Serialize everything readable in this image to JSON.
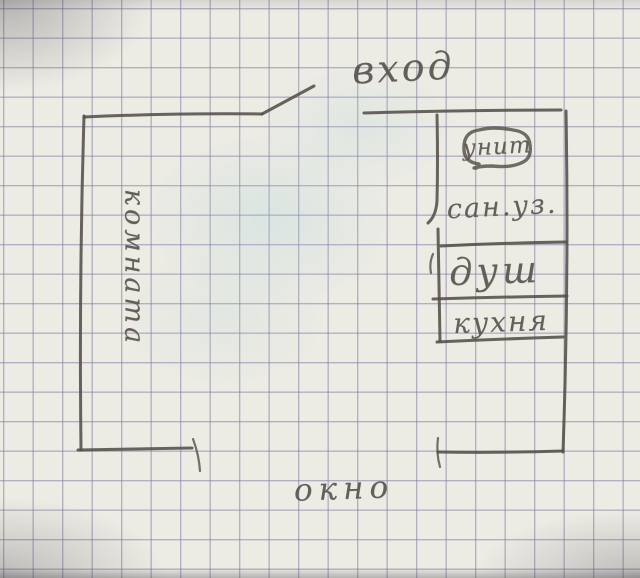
{
  "labels": {
    "entrance": "вход",
    "room": "комната",
    "toilet": "унит",
    "san_unit": "сан.уз.",
    "shower": "душ",
    "kitchen": "кухня",
    "window": "окно"
  },
  "colors": {
    "paper": "#ecebe4",
    "grid_line": "#7a749e",
    "pencil": "#544f48"
  }
}
